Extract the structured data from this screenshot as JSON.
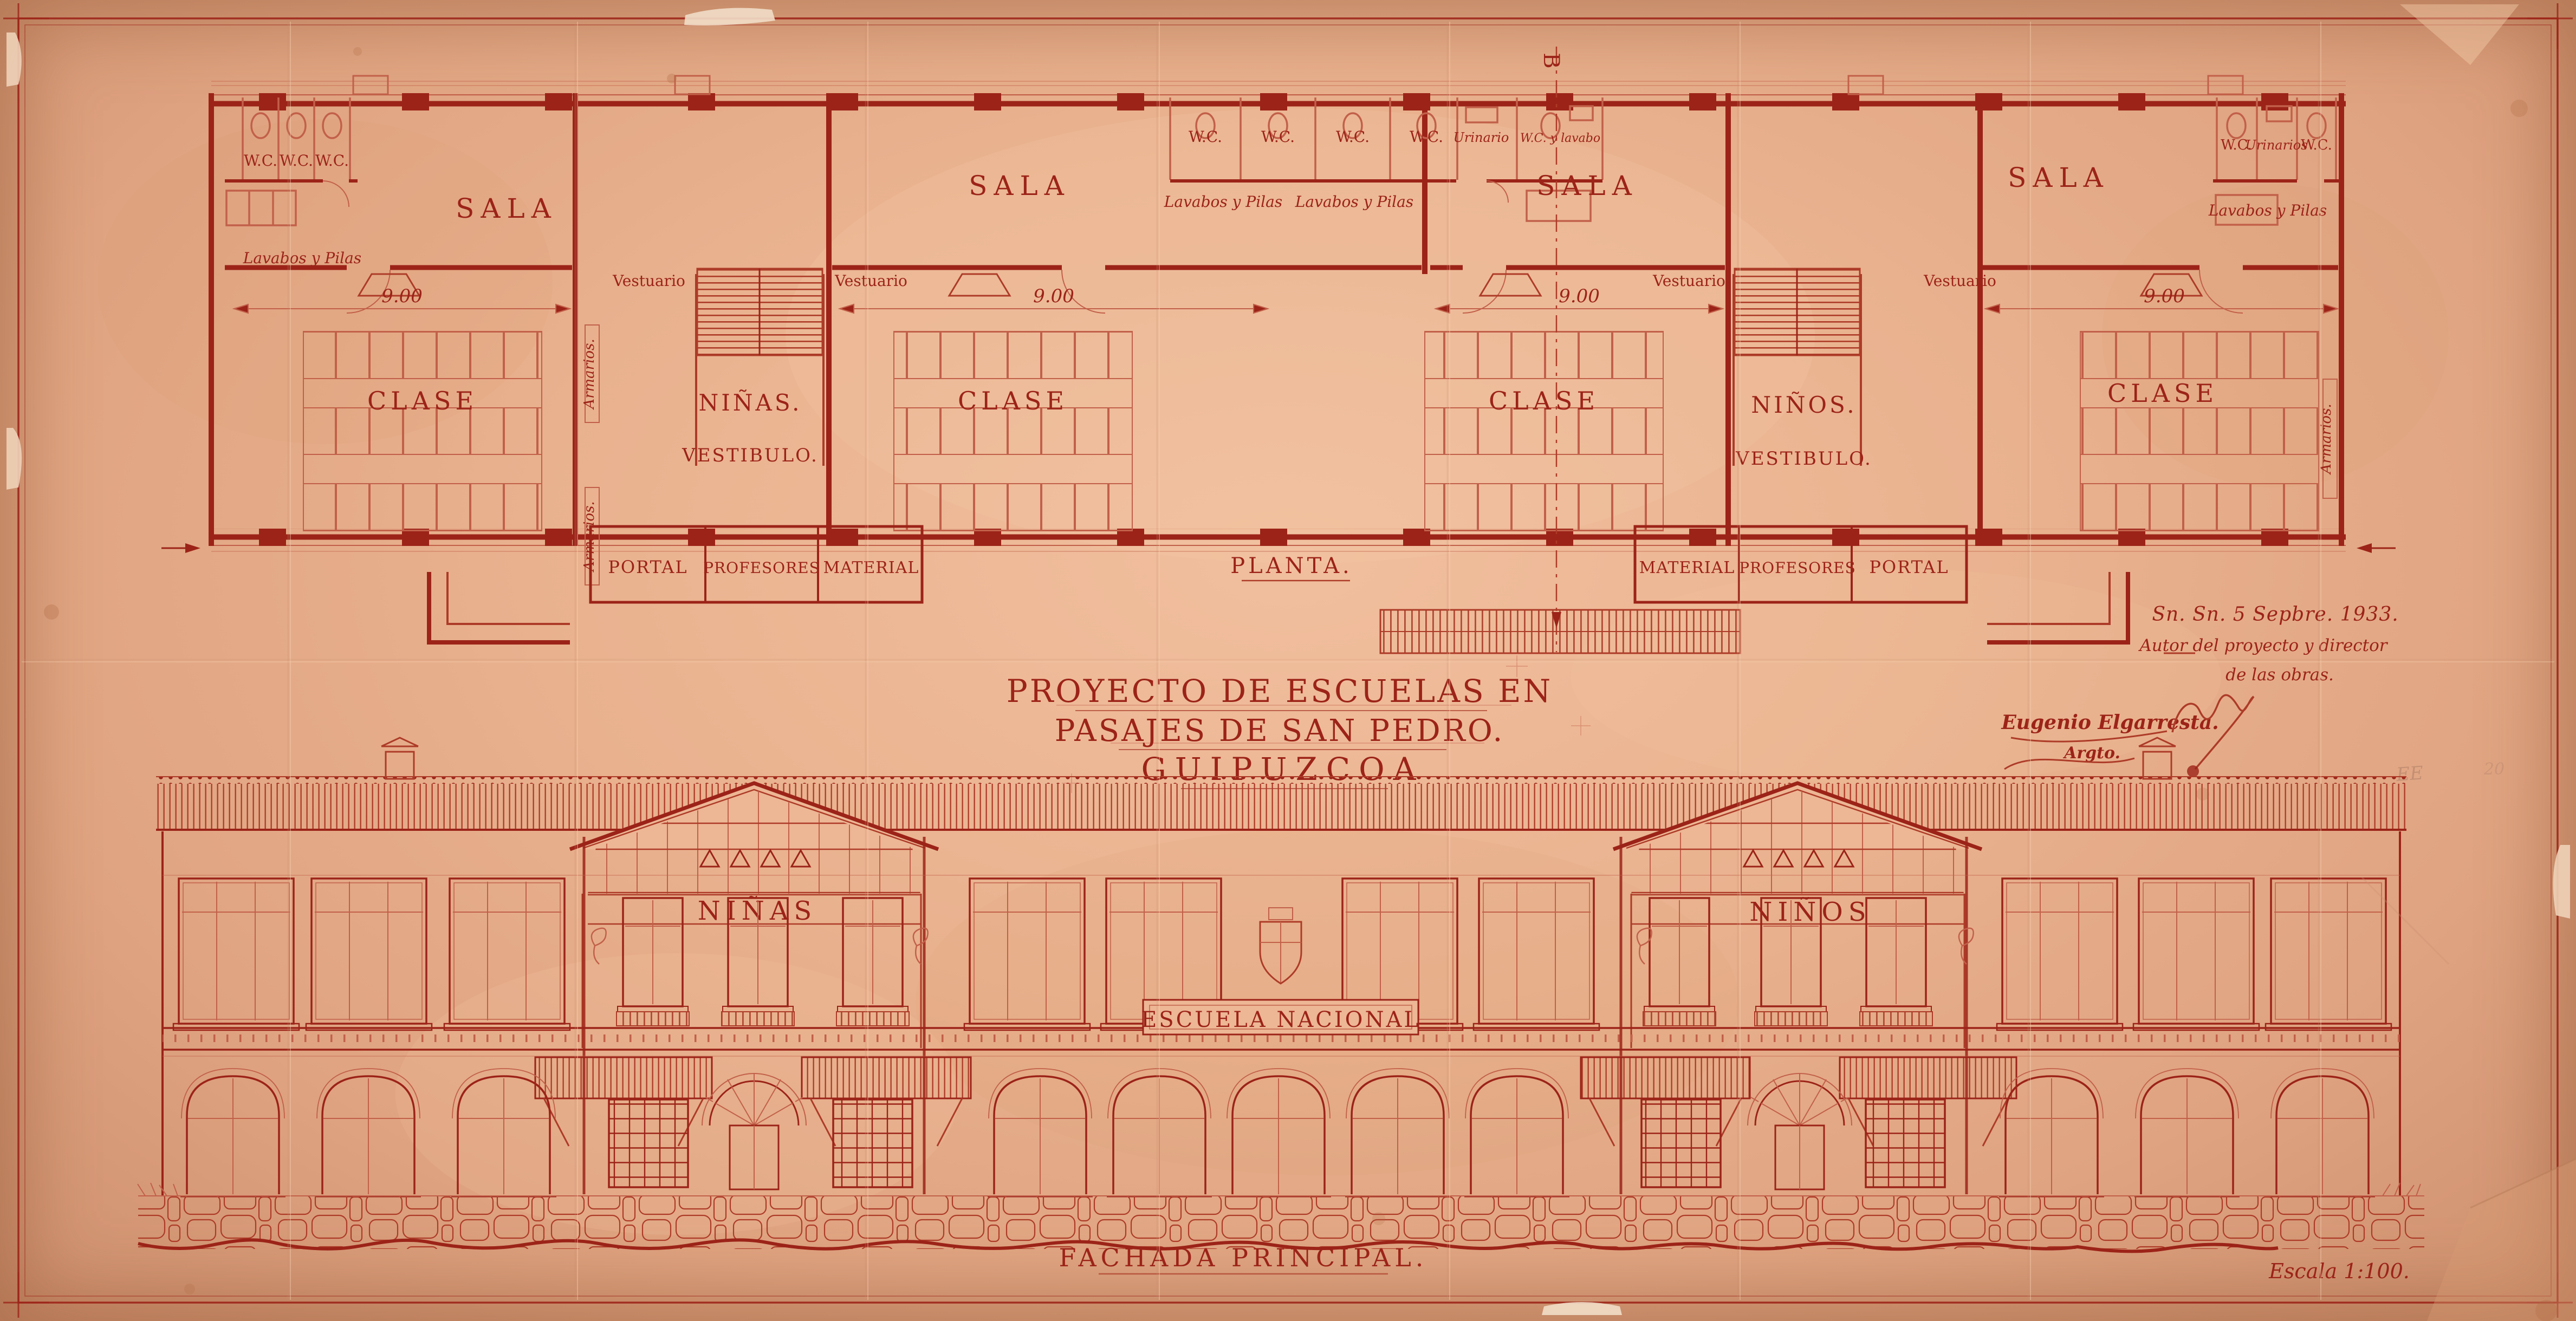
{
  "sheet": {
    "colors": {
      "paper": "#e9b18e",
      "ink": "#9c2318",
      "ink_light": "#c2604a"
    },
    "title": {
      "line1": "PROYECTO DE ESCUELAS EN",
      "line2": "PASAJES DE SAN PEDRO.",
      "line3": "GUIPUZCOA"
    },
    "annotations": {
      "date": "Sn. Sn. 5 Sepbre. 1933.",
      "author1": "Autor del proyecto y director",
      "author2": "de las obras.",
      "signature_name": "Eugenio Elgarresta.",
      "signature_role": "Argto.",
      "pencil_a": "EE",
      "pencil_b": "20"
    },
    "plan": {
      "caption": "PLANTA.",
      "section_letter": "B",
      "labels": {
        "sala": "SALA",
        "clase": "CLASE",
        "dim": "9.00",
        "vestuario": "Vestuario",
        "armarios": "Armarios.",
        "ninas": "NIÑAS.",
        "ninos": "NIÑOS.",
        "vestibulo": "VESTIBULO.",
        "portal": "PORTAL",
        "profesores": "PROFESORES",
        "material": "MATERIAL",
        "wc": "W.C.",
        "urinario": "Urinario",
        "urinarios": "Urinarios",
        "wc_lavabo": "W.C. y lavabo",
        "lavabos": "Lavabos y Pilas"
      }
    },
    "elevation": {
      "caption": "FACHADA PRINCIPAL.",
      "ninas": "NIÑAS",
      "ninos": "NIÑOS",
      "plaque": "ESCUELA NACIONAL",
      "scale": "Escala 1:100."
    }
  }
}
